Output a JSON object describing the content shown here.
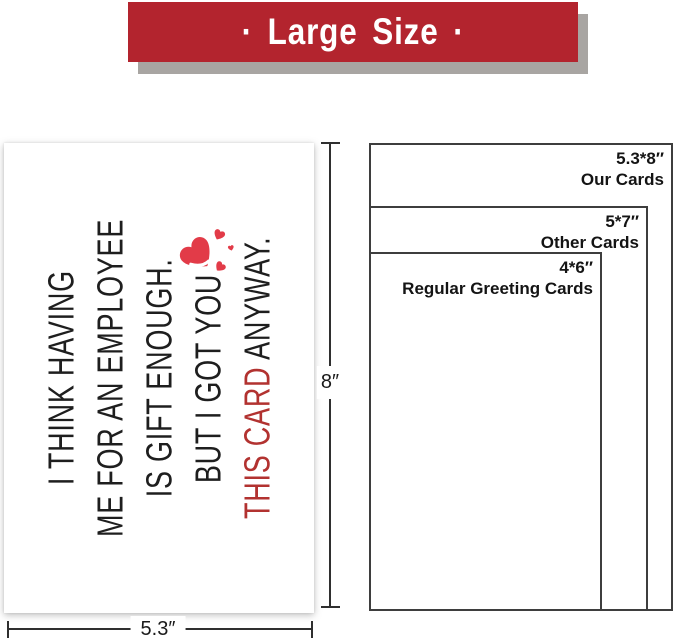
{
  "banner": {
    "label": "· Large Size ·"
  },
  "card": {
    "line1": "I THINK HAVING",
    "line2": "ME FOR AN EMPLOYEE",
    "line3": "IS GIFT ENOUGH.",
    "line4": "BUT I GOT YOU",
    "line5_accent": "THIS CARD",
    "line5_rest": " ANYWAY.",
    "heart_icon": "hearts-cluster-icon"
  },
  "dimensions": {
    "height_label": "8″",
    "width_label": "5.3″"
  },
  "comparison": {
    "our_cards": {
      "size": "5.3*8″",
      "name": "Our Cards"
    },
    "other_cards": {
      "size": "5*7″",
      "name": "Other Cards"
    },
    "regular_cards": {
      "size": "4*6″",
      "name": "Regular Greeting Cards"
    }
  },
  "colors": {
    "banner_bg": "#b3242e",
    "banner_shadow": "#a8a5a2",
    "banner_text": "#ffffff",
    "card_text": "#1e1e1e",
    "accent_red": "#b23230",
    "heart_red": "#e23b48",
    "outline": "#3e3e3e",
    "dim_line": "#2f2f2f"
  }
}
